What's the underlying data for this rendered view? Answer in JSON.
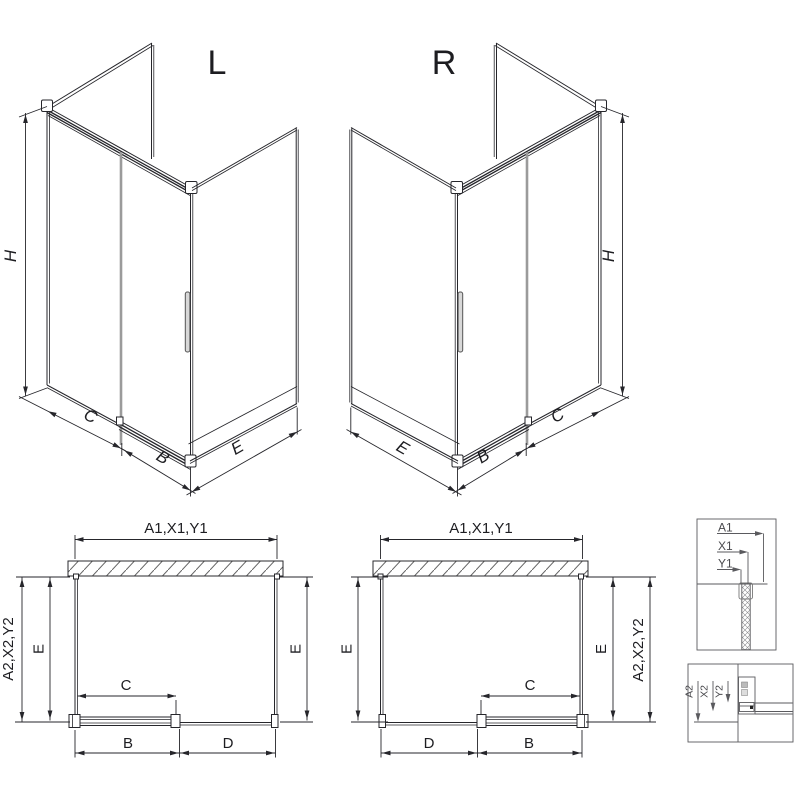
{
  "drawing": {
    "type": "shower-enclosure-technical-drawing",
    "colors": {
      "line": "#26262b",
      "glass_edge": "#9b9b9b",
      "background": "#ffffff"
    },
    "iso_left": {
      "label": "L",
      "dim_height": "H",
      "dim_side": "C",
      "dim_door": "B",
      "dim_return": "E"
    },
    "iso_right": {
      "label": "R",
      "dim_height": "H",
      "dim_side": "E",
      "dim_door": "B",
      "dim_return": "C"
    },
    "plan_left": {
      "dim_top": "A1,X1,Y1",
      "dim_outer_left": "A2,X2,Y2",
      "dim_left": "E",
      "dim_right": "E",
      "dim_opening": "C",
      "dim_bottom_left": "B",
      "dim_bottom_right": "D"
    },
    "plan_right": {
      "dim_top": "A1,X1,Y1",
      "dim_outer_right": "A2,X2,Y2",
      "dim_left": "E",
      "dim_right": "E",
      "dim_opening": "C",
      "dim_bottom_left": "D",
      "dim_bottom_right": "B"
    },
    "detail_top": {
      "labels": [
        "A1",
        "X1",
        "Y1"
      ]
    },
    "detail_bottom": {
      "labels": [
        "A2",
        "X2",
        "Y2"
      ]
    }
  }
}
